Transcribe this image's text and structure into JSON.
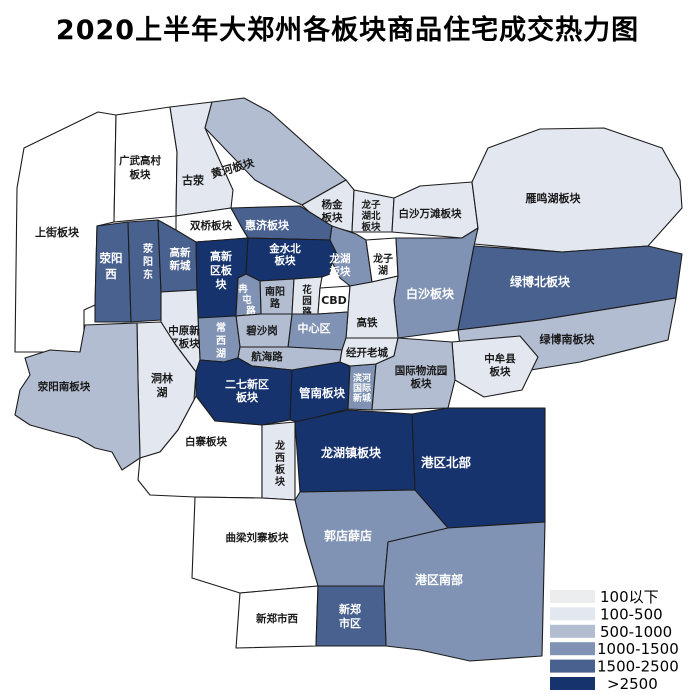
{
  "title": "2020上半年大郑州各板块商品住宅成交热力图",
  "legend": {
    "items": [
      {
        "label": "100以下",
        "color": "#ECEDEE"
      },
      {
        "label": "100-500",
        "color": "#E2E7F0"
      },
      {
        "label": "500-1000",
        "color": "#B2BDD1"
      },
      {
        "label": "1000-1500",
        "color": "#8093B4"
      },
      {
        "label": "1500-2500",
        "color": "#49618F"
      },
      {
        "label": ">2500",
        "color": "#16336E"
      }
    ]
  },
  "map": {
    "regions": [
      {
        "name": "上街板块",
        "lines": [
          "上街板块"
        ],
        "level": null,
        "fill": "#FFFFFF",
        "text_fill": "#1A1A1A"
      },
      {
        "name": "广武高村板块",
        "lines": [
          "广武高村",
          "板块"
        ],
        "level": null,
        "fill": "#FFFFFF",
        "text_fill": "#1A1A1A"
      },
      {
        "name": "古荥",
        "lines": [
          "古荥"
        ],
        "level": "100-500",
        "fill": "#E2E7F0",
        "text_fill": "#1A1A1A"
      },
      {
        "name": "黄河板块",
        "lines": [
          "黄河板块"
        ],
        "level": "500-1000",
        "fill": "#B2BDD1",
        "text_fill": "#1A1A1A"
      },
      {
        "name": "双桥板块",
        "lines": [
          "双桥板块"
        ],
        "level": null,
        "fill": "#FFFFFF",
        "text_fill": "#1A1A1A"
      },
      {
        "name": "杨金板块",
        "lines": [
          "杨金",
          "板块"
        ],
        "level": "100-500",
        "fill": "#E2E7F0",
        "text_fill": "#1A1A1A"
      },
      {
        "name": "龙子湖北板块",
        "lines": [
          "龙子",
          "湖北",
          "板块"
        ],
        "level": "100-500",
        "fill": "#E2E7F0",
        "text_fill": "#1A1A1A"
      },
      {
        "name": "白沙万滩板块",
        "lines": [
          "白沙万滩板块"
        ],
        "level": "100-500",
        "fill": "#E2E7F0",
        "text_fill": "#1A1A1A"
      },
      {
        "name": "雁鸣湖板块",
        "lines": [
          "雁鸣湖板块"
        ],
        "level": "100-500",
        "fill": "#E2E7F0",
        "text_fill": "#1A1A1A"
      },
      {
        "name": "荥阳西",
        "lines": [
          "荥阳",
          "西"
        ],
        "level": "1500-2500",
        "fill": "#49618F",
        "text_fill": "#FFFFFF"
      },
      {
        "name": "荥阳东",
        "lines": [
          "荥",
          "阳",
          "东"
        ],
        "level": "1500-2500",
        "fill": "#49618F",
        "text_fill": "#FFFFFF"
      },
      {
        "name": "高新新城",
        "lines": [
          "高新",
          "新城"
        ],
        "level": "1500-2500",
        "fill": "#49618F",
        "text_fill": "#FFFFFF"
      },
      {
        "name": "高新区板块",
        "lines": [
          "高新",
          "区板",
          "块"
        ],
        "level": ">2500",
        "fill": "#16336E",
        "text_fill": "#FFFFFF"
      },
      {
        "name": "惠济板块",
        "lines": [
          "惠济板块"
        ],
        "level": "1500-2500",
        "fill": "#49618F",
        "text_fill": "#FFFFFF"
      },
      {
        "name": "金水北板块",
        "lines": [
          "金水北",
          "板块"
        ],
        "level": ">2500",
        "fill": "#16336E",
        "text_fill": "#FFFFFF"
      },
      {
        "name": "龙湖板块",
        "lines": [
          "龙湖",
          "板块"
        ],
        "level": "1000-1500",
        "fill": "#8093B4",
        "text_fill": "#FFFFFF"
      },
      {
        "name": "龙子湖",
        "lines": [
          "龙子",
          "湖"
        ],
        "level": null,
        "fill": "#FFFFFF",
        "text_fill": "#1A1A1A"
      },
      {
        "name": "白沙板块",
        "lines": [
          "白沙板块"
        ],
        "level": "1000-1500",
        "fill": "#8093B4",
        "text_fill": "#FFFFFF"
      },
      {
        "name": "绿博北板块",
        "lines": [
          "绿博北板块"
        ],
        "level": "1500-2500",
        "fill": "#49618F",
        "text_fill": "#FFFFFF"
      },
      {
        "name": "绿博南板块",
        "lines": [
          "绿博南板块"
        ],
        "level": "500-1000",
        "fill": "#B2BDD1",
        "text_fill": "#1A1A1A"
      },
      {
        "name": "中牟县板块",
        "lines": [
          "中牟县",
          "板块"
        ],
        "level": "100-500",
        "fill": "#E2E7F0",
        "text_fill": "#1A1A1A"
      },
      {
        "name": "南阳路",
        "lines": [
          "南阳",
          "路"
        ],
        "level": "500-1000",
        "fill": "#B2BDD1",
        "text_fill": "#1A1A1A"
      },
      {
        "name": "冉屯路",
        "lines": [
          "冉",
          "屯",
          "路"
        ],
        "level": "1000-1500",
        "fill": "#8093B4",
        "text_fill": "#FFFFFF"
      },
      {
        "name": "花园路",
        "lines": [
          "花",
          "园",
          "路"
        ],
        "level": "100-500",
        "fill": "#E2E7F0",
        "text_fill": "#1A1A1A"
      },
      {
        "name": "CBD",
        "lines": [
          "CBD"
        ],
        "level": null,
        "fill": "#FFFFFF",
        "text_fill": "#1A1A1A"
      },
      {
        "name": "高铁",
        "lines": [
          "高铁"
        ],
        "level": "100-500",
        "fill": "#E2E7F0",
        "text_fill": "#1A1A1A"
      },
      {
        "name": "中心区",
        "lines": [
          "中心区"
        ],
        "level": "1000-1500",
        "fill": "#8093B4",
        "text_fill": "#FFFFFF"
      },
      {
        "name": "碧沙岗",
        "lines": [
          "碧沙岗"
        ],
        "level": "500-1000",
        "fill": "#B2BDD1",
        "text_fill": "#1A1A1A"
      },
      {
        "name": "常西湖",
        "lines": [
          "常",
          "西",
          "湖"
        ],
        "level": "1000-1500",
        "fill": "#8093B4",
        "text_fill": "#FFFFFF"
      },
      {
        "name": "中原新区板块",
        "lines": [
          "中原新",
          "区板块"
        ],
        "level": "100-500",
        "fill": "#E2E7F0",
        "text_fill": "#1A1A1A"
      },
      {
        "name": "洞林湖",
        "lines": [
          "洞林",
          "湖"
        ],
        "level": "100-500",
        "fill": "#E2E7F0",
        "text_fill": "#1A1A1A"
      },
      {
        "name": "荥阳南板块",
        "lines": [
          "荥阳南板块"
        ],
        "level": "500-1000",
        "fill": "#B2BDD1",
        "text_fill": "#1A1A1A"
      },
      {
        "name": "航海路",
        "lines": [
          "航海路"
        ],
        "level": "500-1000",
        "fill": "#B2BDD1",
        "text_fill": "#1A1A1A"
      },
      {
        "name": "二七新区板块",
        "lines": [
          "二七新区",
          "板块"
        ],
        "level": ">2500",
        "fill": "#16336E",
        "text_fill": "#FFFFFF"
      },
      {
        "name": "管南板块",
        "lines": [
          "管南板块"
        ],
        "level": ">2500",
        "fill": "#16336E",
        "text_fill": "#FFFFFF"
      },
      {
        "name": "滨河国际新城",
        "lines": [
          "滨河",
          "国际",
          "新城"
        ],
        "level": "1000-1500",
        "fill": "#8093B4",
        "text_fill": "#FFFFFF"
      },
      {
        "name": "经开老城",
        "lines": [
          "经开老城"
        ],
        "level": "100-500",
        "fill": "#E2E7F0",
        "text_fill": "#1A1A1A"
      },
      {
        "name": "国际物流园板块",
        "lines": [
          "国际物流园",
          "板块"
        ],
        "level": "500-1000",
        "fill": "#B2BDD1",
        "text_fill": "#1A1A1A"
      },
      {
        "name": "白寨板块",
        "lines": [
          "白寨板块"
        ],
        "level": null,
        "fill": "#FFFFFF",
        "text_fill": "#1A1A1A"
      },
      {
        "name": "龙西板块",
        "lines": [
          "龙",
          "西",
          "板",
          "块"
        ],
        "level": "100-500",
        "fill": "#E2E7F0",
        "text_fill": "#1A1A1A"
      },
      {
        "name": "龙湖镇板块",
        "lines": [
          "龙湖镇板块"
        ],
        "level": ">2500",
        "fill": "#16336E",
        "text_fill": "#FFFFFF"
      },
      {
        "name": "港区北部",
        "lines": [
          "港区北部"
        ],
        "level": ">2500",
        "fill": "#16336E",
        "text_fill": "#FFFFFF"
      },
      {
        "name": "郭店薛店",
        "lines": [
          "郭店薛店"
        ],
        "level": "1000-1500",
        "fill": "#8093B4",
        "text_fill": "#FFFFFF"
      },
      {
        "name": "港区南部",
        "lines": [
          "港区南部"
        ],
        "level": "1000-1500",
        "fill": "#8093B4",
        "text_fill": "#FFFFFF"
      },
      {
        "name": "曲梁刘寨板块",
        "lines": [
          "曲梁刘寨板块"
        ],
        "level": null,
        "fill": "#FFFFFF",
        "text_fill": "#1A1A1A"
      },
      {
        "name": "新郑市西",
        "lines": [
          "新郑市西"
        ],
        "level": null,
        "fill": "#FFFFFF",
        "text_fill": "#1A1A1A"
      },
      {
        "name": "新郑市区",
        "lines": [
          "新郑",
          "市区"
        ],
        "level": "1500-2500",
        "fill": "#49618F",
        "text_fill": "#FFFFFF"
      }
    ]
  }
}
